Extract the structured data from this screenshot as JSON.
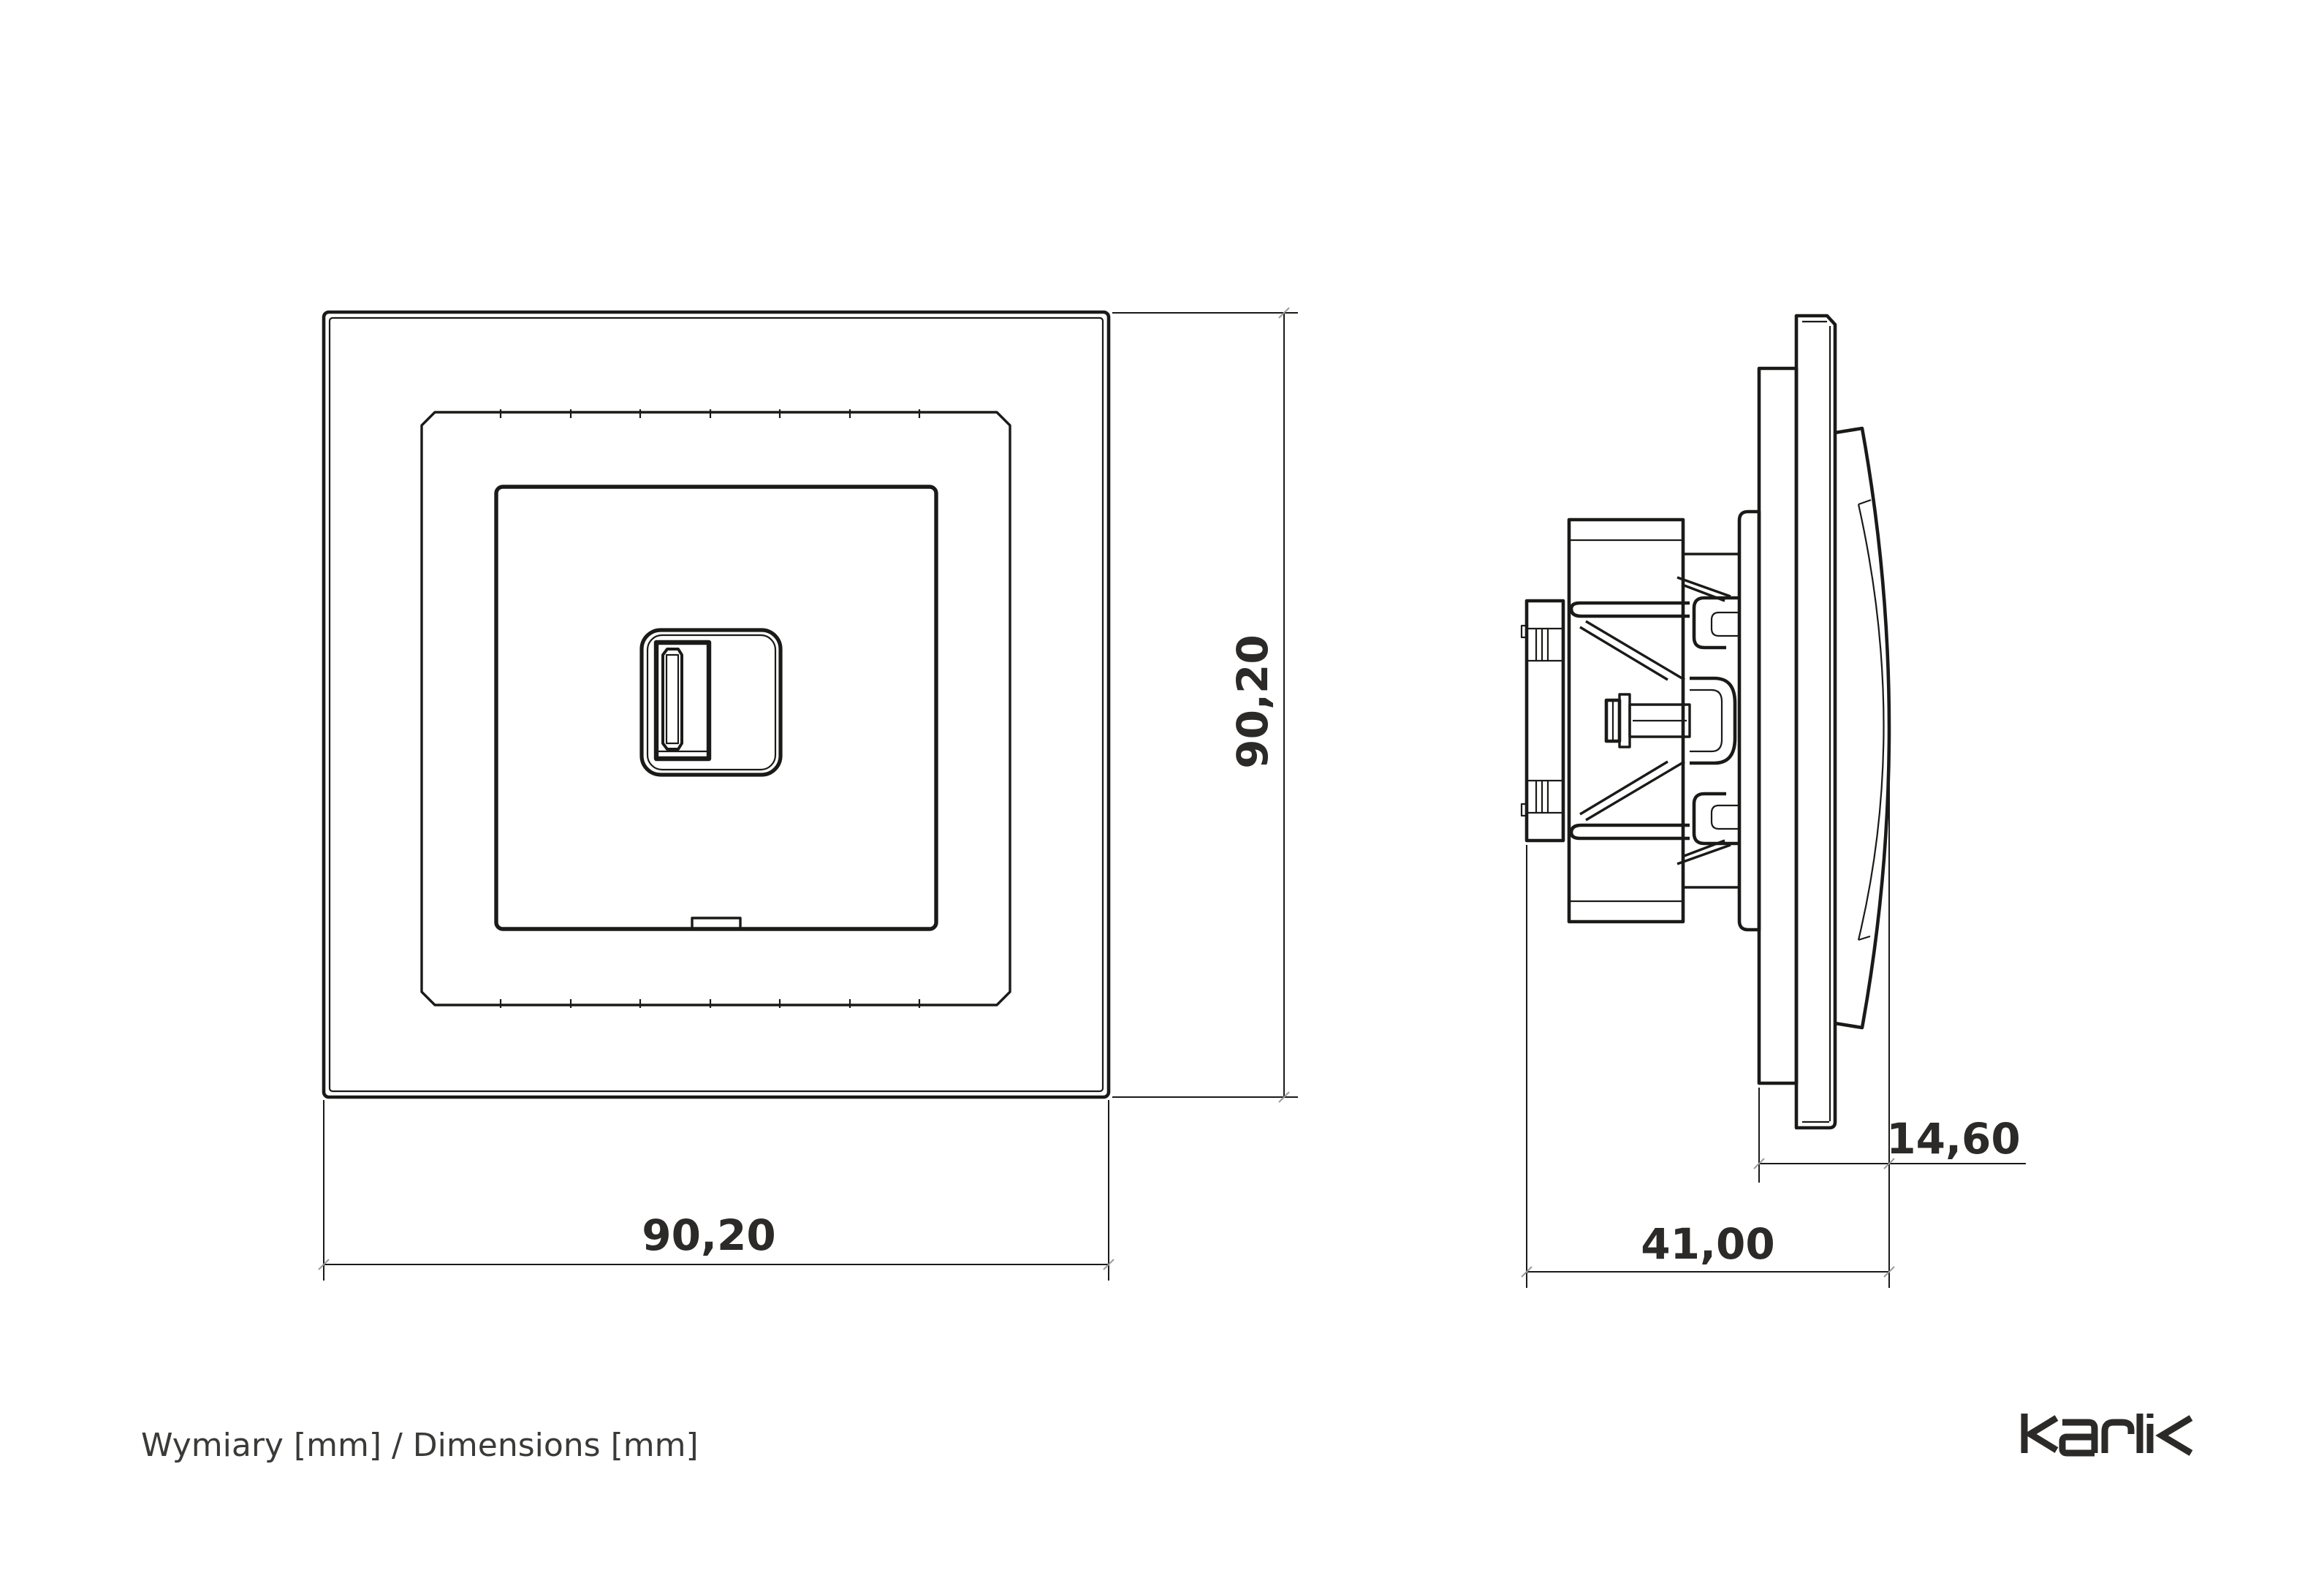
{
  "caption": "Wymiary [mm] / Dimensions [mm]",
  "brand": "karlik",
  "front_view": {
    "description": "front view of single USB socket with frame",
    "width_mm": "90,20",
    "height_mm": "90,20"
  },
  "side_view": {
    "description": "side profile of flush-mounted USB socket mechanism",
    "total_depth_mm": "41,00",
    "front_protrusion_mm": "14,60"
  },
  "colors": {
    "line": "#1a1a19",
    "dim_text": "#2b2a29",
    "background": "#ffffff"
  }
}
